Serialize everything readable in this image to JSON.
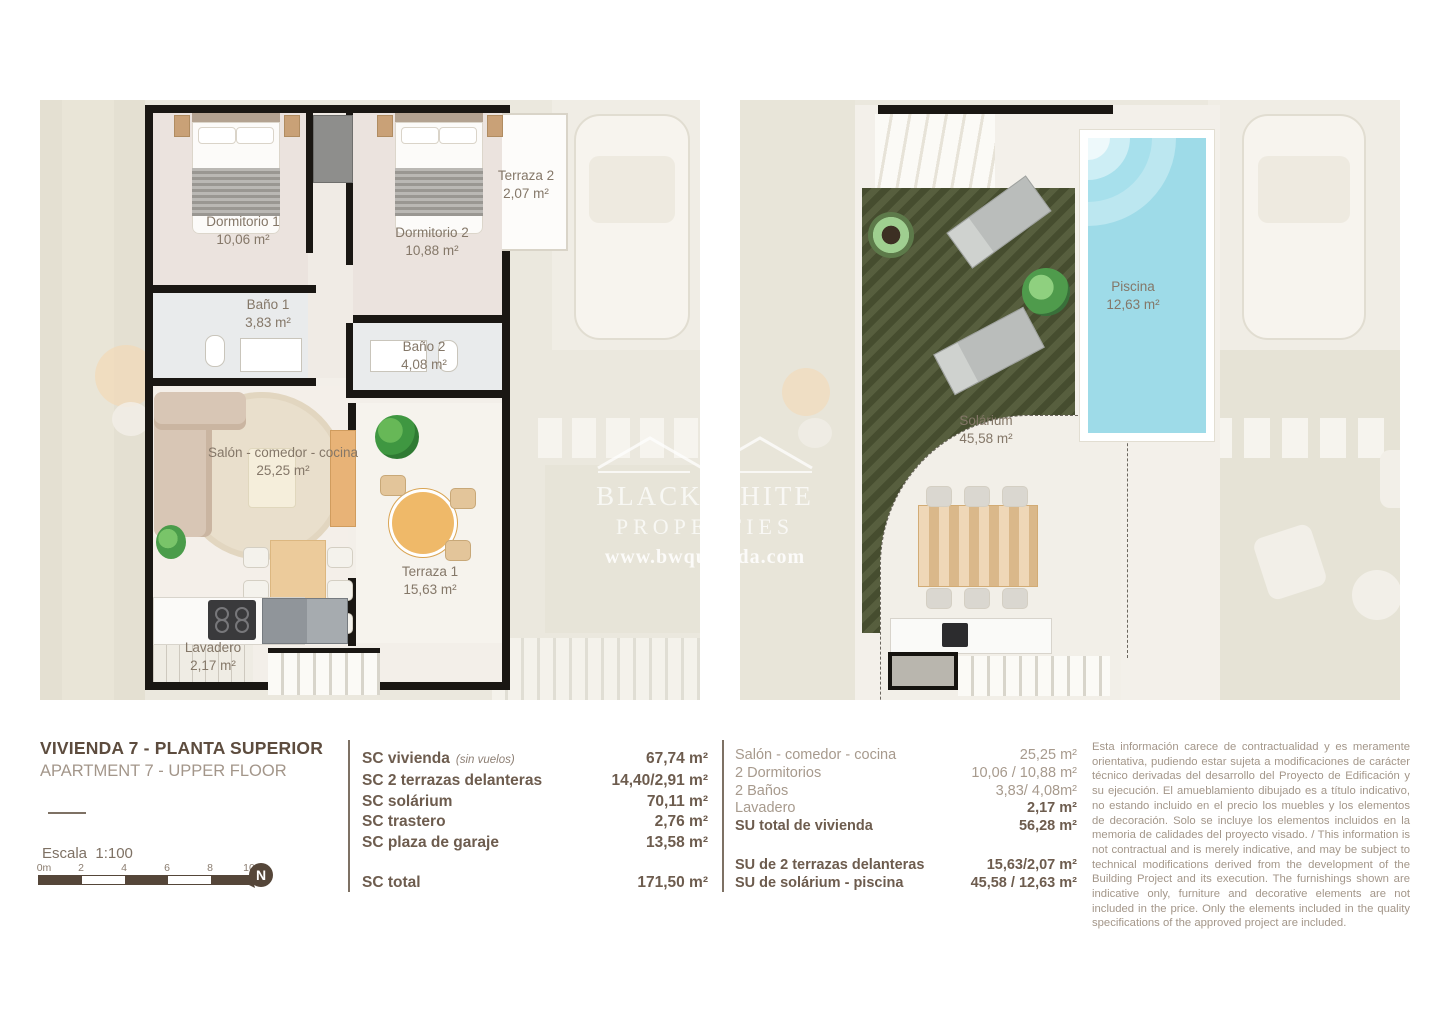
{
  "title_block": {
    "title": "VIVIENDA 7 - PLANTA SUPERIOR",
    "subtitle": "APARTMENT 7 - UPPER FLOOR",
    "scale_label": "Escala  1:100",
    "scale_ticks": [
      "0m",
      "2",
      "4",
      "6",
      "8",
      "10"
    ],
    "compass_letter": "N"
  },
  "left_plan": {
    "rooms": [
      {
        "name": "Dormitorio 1",
        "area": "10,06 m²"
      },
      {
        "name": "Dormitorio 2",
        "area": "10,88 m²"
      },
      {
        "name": "Terraza 2",
        "area": "2,07 m²"
      },
      {
        "name": "Baño 1",
        "area": "3,83 m²"
      },
      {
        "name": "Baño 2",
        "area": "4,08 m²"
      },
      {
        "name": "Salón - comedor - cocina",
        "area": "25,25 m²"
      },
      {
        "name": "Terraza 1",
        "area": "15,63 m²"
      },
      {
        "name": "Lavadero",
        "area": "2,17 m²"
      }
    ]
  },
  "right_plan": {
    "rooms": [
      {
        "name": "Piscina",
        "area": "12,63 m²"
      },
      {
        "name": "Solárium",
        "area": "45,58 m²"
      }
    ]
  },
  "sc_table": {
    "rows": [
      {
        "label": "SC vivienda",
        "note": "(sin vuelos)",
        "value": "67,74 m²"
      },
      {
        "label": "SC 2 terrazas delanteras",
        "note": "",
        "value": "14,40/2,91 m²"
      },
      {
        "label": "SC solárium",
        "note": "",
        "value": "70,11 m²"
      },
      {
        "label": "SC trastero",
        "note": "",
        "value": "2,76 m²"
      },
      {
        "label": "SC plaza de garaje",
        "note": "",
        "value": "13,58 m²"
      }
    ],
    "total": {
      "label": "SC total",
      "value": "171,50 m²"
    }
  },
  "su_table": {
    "rows": [
      {
        "label": "Salón - comedor - cocina",
        "value": "25,25 m²"
      },
      {
        "label": "2 Dormitorios",
        "value": "10,06 / 10,88 m²"
      },
      {
        "label": "2 Baños",
        "value": "3,83/ 4,08m²"
      },
      {
        "label": "Lavadero",
        "value": "2,17 m²"
      },
      {
        "label": "SU total de vivienda",
        "value": "56,28 m²"
      }
    ],
    "rows_bottom": [
      {
        "label": "SU de 2 terrazas delanteras",
        "value": "15,63/2,07 m²"
      },
      {
        "label": "SU de solárium - piscina",
        "value": "45,58 / 12,63 m²"
      }
    ]
  },
  "disclaimer": "Esta información carece de contractualidad y es meramente orientativa, pudiendo estar sujeta a modificaciones de carácter técnico derivadas del desarrollo del Proyecto de Edificación y su ejecución. El amueblamiento dibujado es a título indicativo, no estando incluido en el precio los muebles y los elementos de decoración. Solo se incluye los elementos incluidos en la memoria de calidades del proyecto visado. / This information is not contractual and is merely indicative, and may be subject to technical modifications derived from the development of the Building Project and its execution. The furnishings shown are indicative only, furniture and decorative elements are not included in the price. Only the elements included in the quality specifications of the approved project are included.",
  "watermark": {
    "brand_line1": "BLACK  WHITE",
    "brand_line2": "PROPERTIES",
    "url": "www.bwquesada.com"
  },
  "colors": {
    "wall": "#1a1713",
    "accent_dark_text": "#5d4c3e",
    "light_text": "#a39689",
    "pool": "#9edbe8",
    "grass": "#4e5634",
    "faded_bg": "#ebe8de"
  }
}
